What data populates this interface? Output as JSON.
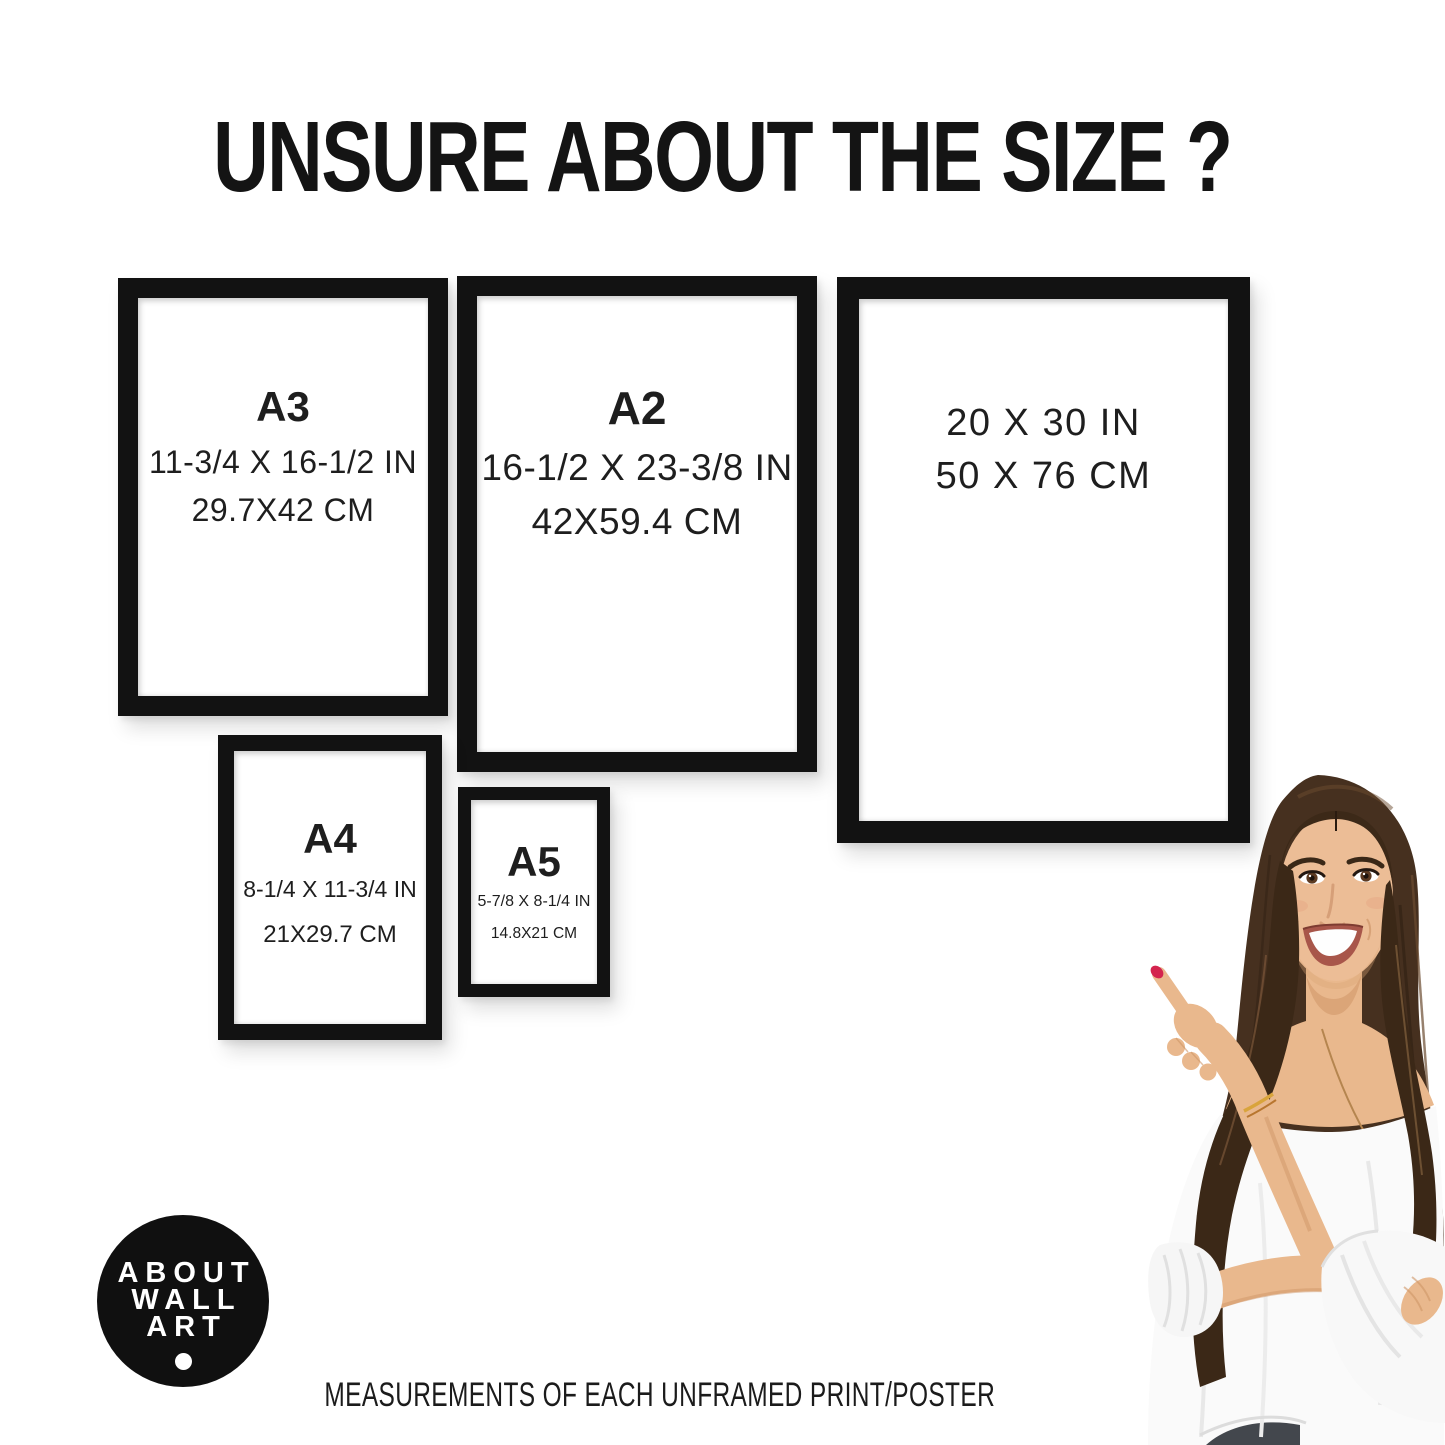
{
  "title": "UNSURE ABOUT THE SIZE ?",
  "frames": [
    {
      "name": "A3",
      "label": "A3",
      "inches": "11-3/4 X 16-1/2 IN",
      "cm": "29.7X42 CM"
    },
    {
      "name": "A2",
      "label": "A2",
      "inches": "16-1/2 X 23-3/8 IN",
      "cm": "42X59.4 CM"
    },
    {
      "name": "20x30",
      "label": "",
      "inches": "20 X 30 IN",
      "cm": "50 X 76 CM"
    },
    {
      "name": "A4",
      "label": "A4",
      "inches": "8-1/4 X 11-3/4 IN",
      "cm": "21X29.7 CM"
    },
    {
      "name": "A5",
      "label": "A5",
      "inches": "5-7/8 X 8-1/4 IN",
      "cm": "14.8X21 CM"
    }
  ],
  "logo": {
    "line1": "ABOUT",
    "line2": "WALL",
    "line3": "ART"
  },
  "caption": "MEASUREMENTS OF EACH UNFRAMED PRINT/POSTER",
  "colors": {
    "frame": "#121212",
    "text": "#1e1e1e",
    "background": "#ffffff",
    "logo_bg": "#101010",
    "logo_text": "#ffffff",
    "hair": "#46301f",
    "skin": "#e9b88d",
    "blouse": "#fafafa",
    "nail": "#d4244e"
  }
}
